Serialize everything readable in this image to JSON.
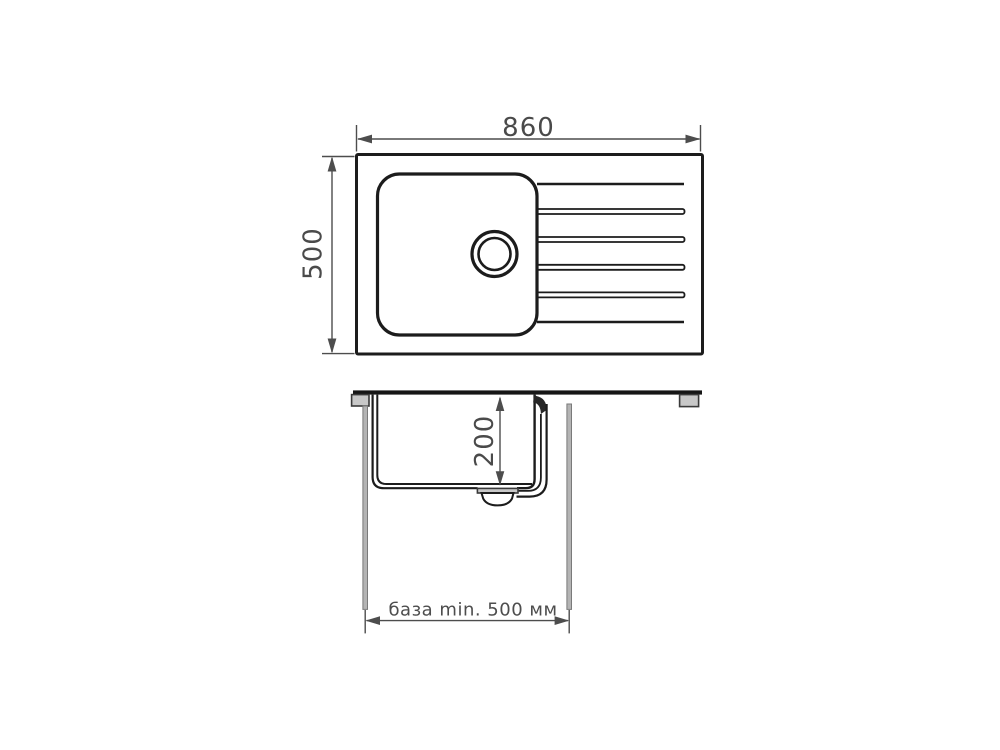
{
  "diagram": {
    "labels": {
      "overall_width": "860",
      "overall_depth": "500",
      "bowl_depth": "200",
      "cabinet_base": "база min. 500 мм"
    },
    "colors": {
      "outline": "#1c1c1c",
      "dimension": "#4d4d4d",
      "countertop_fill": "#161616",
      "clip_fill": "#c8c8c8",
      "panel_fill": "#b4b4b4",
      "groove_fill": "#dcdcdc",
      "background": "#ffffff"
    }
  }
}
